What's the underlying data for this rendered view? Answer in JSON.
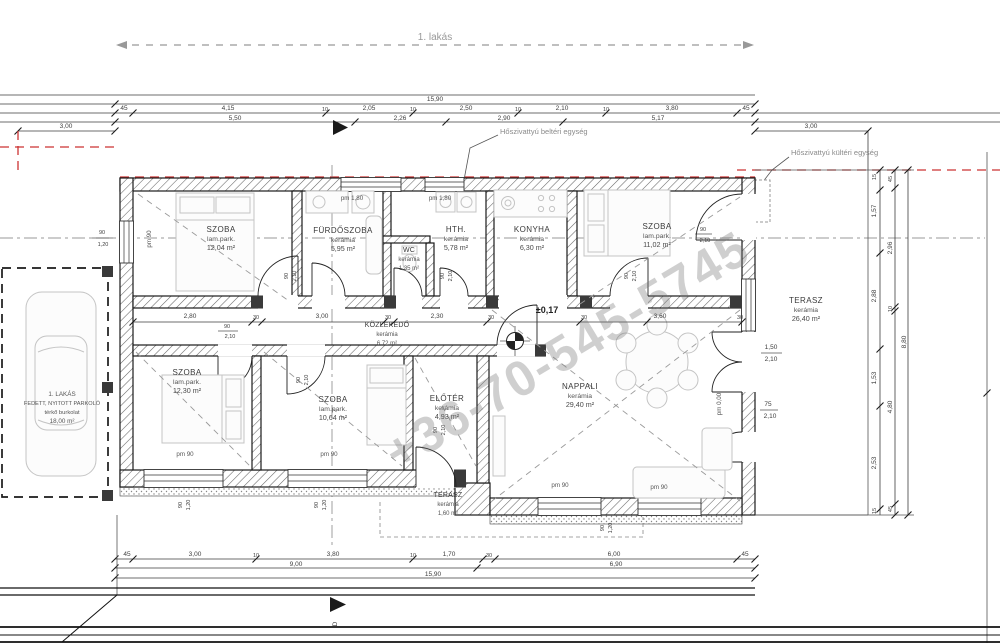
{
  "header": {
    "apartment_label": "1. lakás"
  },
  "watermark": "+36-70-545-5745",
  "markers": {
    "level": "±0,17",
    "section": "D"
  },
  "notes": {
    "hp_indoor": "Hőszivattyú beltéri egység",
    "hp_outdoor": "Hőszivattyú kültéri egység"
  },
  "parking": {
    "l1": "1. LAKÁS",
    "l2": "FEDETT, NYITOTT PARKOLÓ",
    "l3": "térkő burkolat",
    "l4": "18,00 m²"
  },
  "rooms": [
    {
      "name": "SZOBA",
      "material": "lam.park.",
      "area": "12,04 m²"
    },
    {
      "name": "FÜRDŐSZOBA",
      "material": "kerámia",
      "area": "5,95 m²"
    },
    {
      "name": "WC",
      "material": "kerámia",
      "area": "1,35 m²"
    },
    {
      "name": "HTH.",
      "material": "kerámia",
      "area": "5,78 m²"
    },
    {
      "name": "KONYHA",
      "material": "kerámia",
      "area": "6,30 m²"
    },
    {
      "name": "SZOBA",
      "material": "lam.park.",
      "area": "11,02 m²"
    },
    {
      "name": "KÖZLEKEDŐ",
      "material": "kerámia",
      "area": "6,72 m²"
    },
    {
      "name": "SZOBA",
      "material": "lam.park.",
      "area": "12,30 m²"
    },
    {
      "name": "SZOBA",
      "material": "lam.park.",
      "area": "10,64 m²"
    },
    {
      "name": "ELŐTÉR",
      "material": "kerámia",
      "area": "4,93 m²"
    },
    {
      "name": "NAPPALI",
      "material": "kerámia",
      "area": "29,40 m²"
    },
    {
      "name": "TERASZ",
      "material": "kerámia",
      "area": "1,60 m²"
    },
    {
      "name": "TERASZ",
      "material": "kerámia",
      "area": "26,40 m²"
    }
  ],
  "dims": {
    "top_total": "15,90",
    "row2": [
      "45",
      "4,15",
      "10",
      "2,05",
      "10",
      "2,50",
      "10",
      "2,10",
      "10",
      "3,80",
      "45"
    ],
    "row3": [
      "5,50",
      "2,26",
      "2,90",
      "5,17"
    ],
    "offset_left": "3,00",
    "offset_right": "3,00",
    "mid": [
      "2,80",
      "30",
      "3,00",
      "30",
      "2,30",
      "30",
      "30",
      "3,60",
      "30"
    ],
    "bottom1": [
      "45",
      "3,00",
      "10",
      "3,80",
      "10",
      "1,70",
      "30",
      "6,00",
      "45"
    ],
    "bottom2": [
      "9,00",
      "6,90"
    ],
    "bottom_total": "15,90",
    "rv1": [
      "15",
      "1,57",
      "2,88",
      "1,53",
      "2,53",
      "15"
    ],
    "rv2": [
      "45",
      "2,96",
      "10",
      "4,80",
      "45"
    ],
    "rv_total": "8,80"
  },
  "openings": {
    "w90": "90",
    "h120": "1,20",
    "d90": "90",
    "h210": "2,10",
    "d150": "1,50",
    "d75": "75",
    "pm90": "pm 90",
    "pm180": "pm 1,80",
    "pm000": "pm 0,00"
  }
}
